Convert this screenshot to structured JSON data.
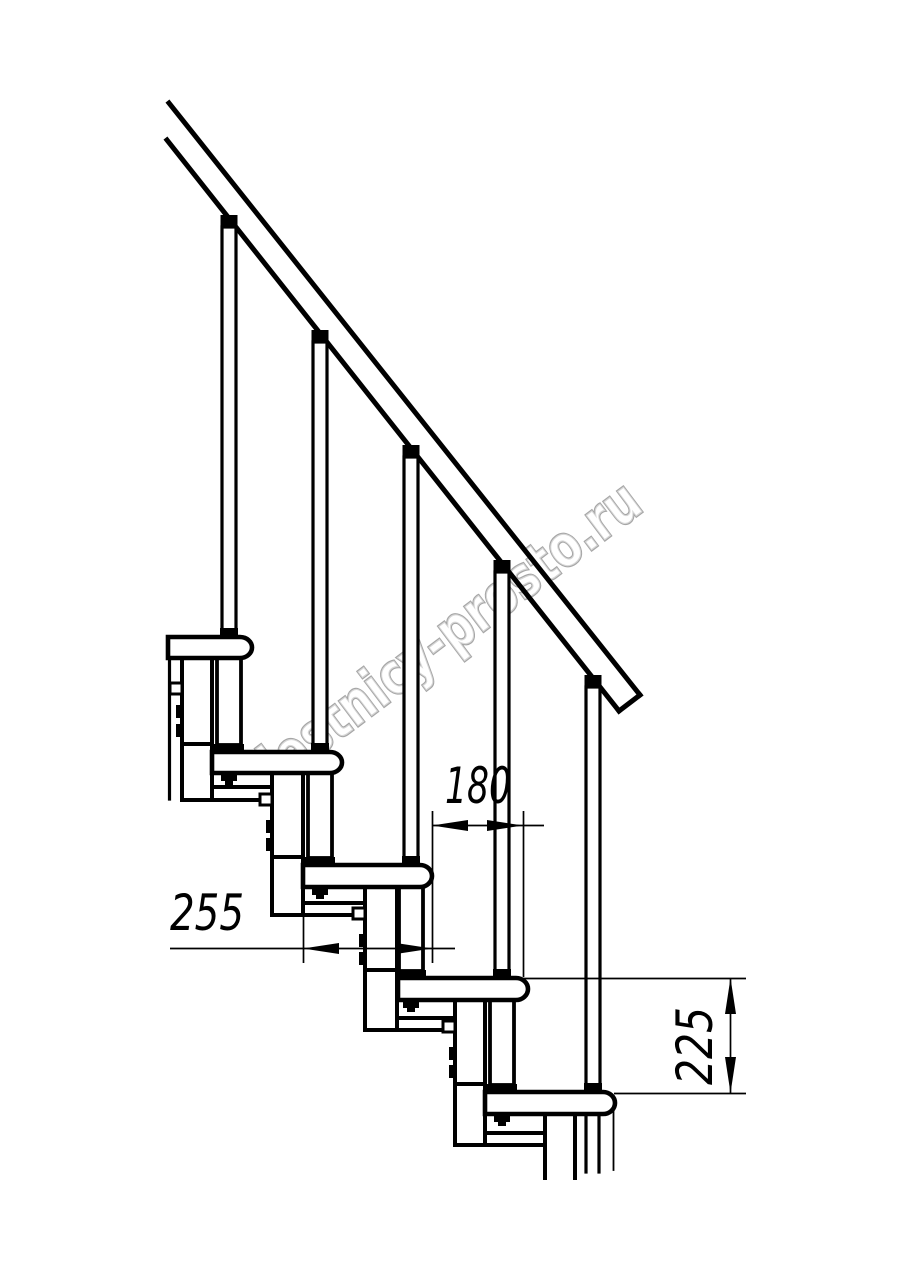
{
  "drawing": {
    "watermark": "lestnicy-prosto.ru",
    "line_color": "#000000",
    "background_color": "#ffffff",
    "watermark_outline_color": "#969696",
    "dimensions": {
      "tread_depth": "255",
      "step_overlap": "180",
      "step_rise": "225"
    }
  }
}
